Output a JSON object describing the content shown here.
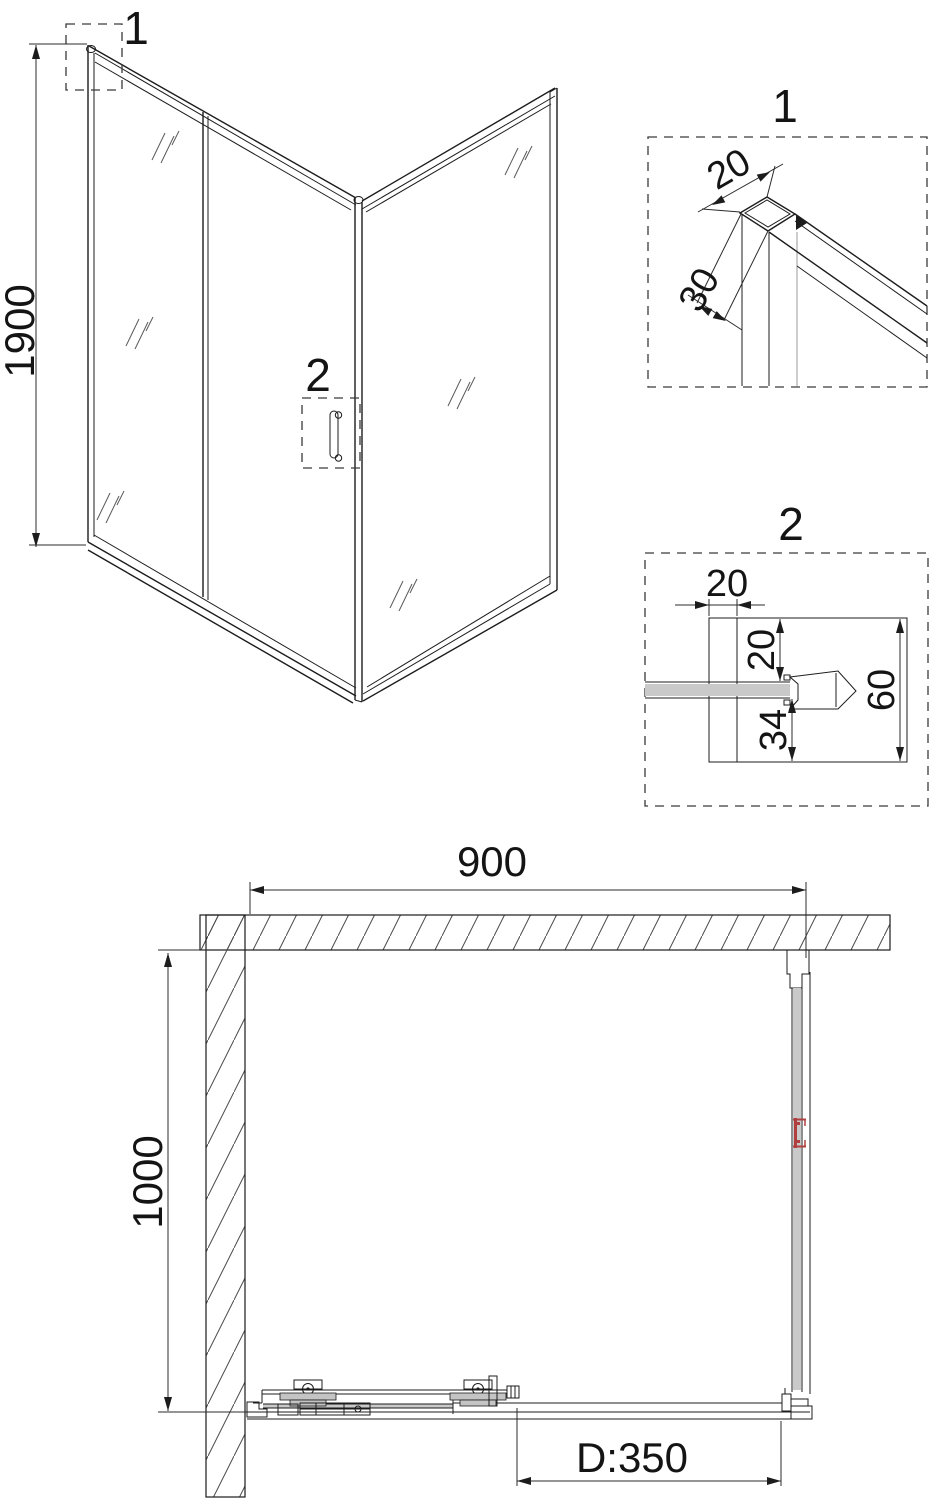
{
  "colors": {
    "line": "#1c1c1c",
    "dim_line": "#2b2b2b",
    "hatch": "#4a4a4a",
    "glass_fill": "#c9c9c9",
    "plate_fill": "#c4c4c4",
    "handle_red": "#b04040"
  },
  "perspective_view": {
    "callout_1": "1",
    "callout_2": "2",
    "dim_height": "1900"
  },
  "detail_1": {
    "label": "1",
    "dim_profile_width": "20",
    "dim_profile_depth": "30"
  },
  "detail_2": {
    "label": "2",
    "dim_profile_width": "20",
    "dim_glass_offset_top": "20",
    "dim_glass_offset_bottom": "34",
    "dim_total_height": "60"
  },
  "plan_view": {
    "dim_width": "900",
    "dim_depth": "1000",
    "dim_door_opening": "D:350"
  }
}
